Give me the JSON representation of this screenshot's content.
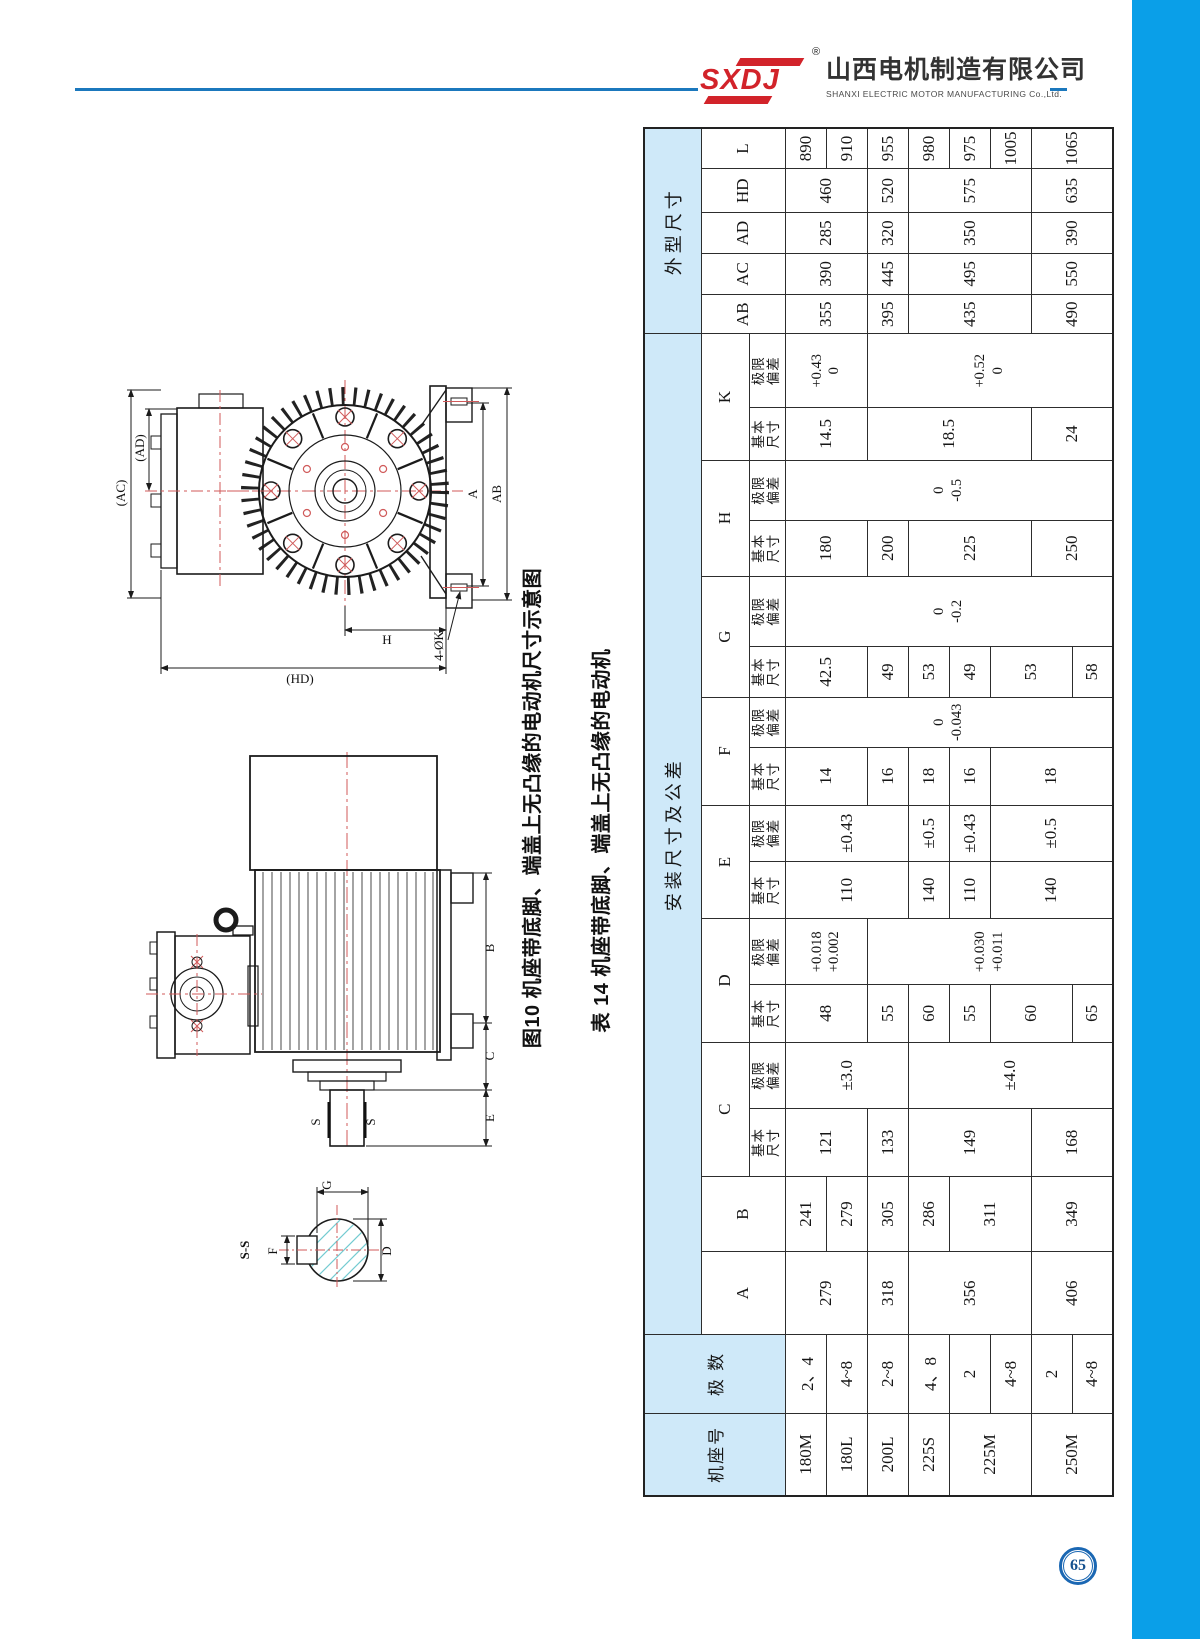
{
  "page": {
    "number": "65"
  },
  "header": {
    "logo_mark": "SXDJ",
    "reg": "®",
    "company_cn": "山西电机制造有限公司",
    "company_en": "SHANXI ELECTRIC MOTOR MANUFACTURING Co.,Ltd."
  },
  "figure": {
    "caption": "图10 机座带底脚、端盖上无凸缘的电动机尺寸示意图",
    "end_view": {
      "ad": "(AD)",
      "ac": "(AC)",
      "hd": "(HD)",
      "a": "A",
      "ab": "AB",
      "h": "H",
      "k": "4-ØK"
    },
    "side_view": {
      "b": "B",
      "c": "C",
      "e": "E",
      "s_left": "S",
      "s_right": "S"
    },
    "section": {
      "title": "S-S",
      "g": "G",
      "f": "F",
      "d": "D"
    }
  },
  "table": {
    "title": "表 14 机座带底脚、端盖上无凸缘的电动机",
    "headers": {
      "frame": "机座号",
      "poles": "极 数",
      "mount_group": "安装尺寸及公差",
      "outline_group": "外型尺寸",
      "basic": "基本\n尺寸",
      "dev": "极限\n偏差",
      "cols": [
        "A",
        "B",
        "C",
        "D",
        "E",
        "F",
        "G",
        "H",
        "K",
        "AB",
        "AC",
        "AD",
        "HD",
        "L"
      ]
    },
    "frame": [
      "180M",
      "180L",
      "200L",
      "225S",
      "225M",
      "250M"
    ],
    "poles": [
      "2、4",
      "4~8",
      "2~8",
      "4、8",
      "2",
      "4~8",
      "2",
      "4~8"
    ],
    "A": [
      "279",
      "318",
      "356",
      "406"
    ],
    "B": [
      "241",
      "279",
      "305",
      "286",
      "311",
      "349"
    ],
    "C_basic": [
      "121",
      "133",
      "149",
      "168"
    ],
    "C_dev": [
      "±3.0",
      "±4.0"
    ],
    "D_basic": [
      "48",
      "55",
      "60",
      "55",
      "60",
      "65"
    ],
    "D_dev": [
      "+0.018\n+0.002",
      "+0.030\n+0.011"
    ],
    "E_basic": [
      "110",
      "140",
      "110",
      "140"
    ],
    "E_dev": [
      "±0.43",
      "±0.5",
      "±0.43",
      "±0.5"
    ],
    "F_basic": [
      "14",
      "16",
      "18",
      "16",
      "18"
    ],
    "F_dev": [
      "0\n-0.043"
    ],
    "G_basic": [
      "42.5",
      "49",
      "53",
      "49",
      "53",
      "58"
    ],
    "G_dev": [
      "0\n-0.2"
    ],
    "H_basic": [
      "180",
      "200",
      "225",
      "250"
    ],
    "H_dev": [
      "0\n-0.5"
    ],
    "K_basic": [
      "14.5",
      "18.5",
      "24"
    ],
    "K_dev": [
      "+0.43\n0",
      "+0.52\n0"
    ],
    "AB": [
      "355",
      "395",
      "435",
      "490"
    ],
    "AC": [
      "390",
      "445",
      "495",
      "550"
    ],
    "AD": [
      "285",
      "320",
      "350",
      "390"
    ],
    "HD": [
      "460",
      "520",
      "575",
      "635"
    ],
    "L": [
      "890",
      "910",
      "955",
      "980",
      "975",
      "1005",
      "1065"
    ]
  }
}
